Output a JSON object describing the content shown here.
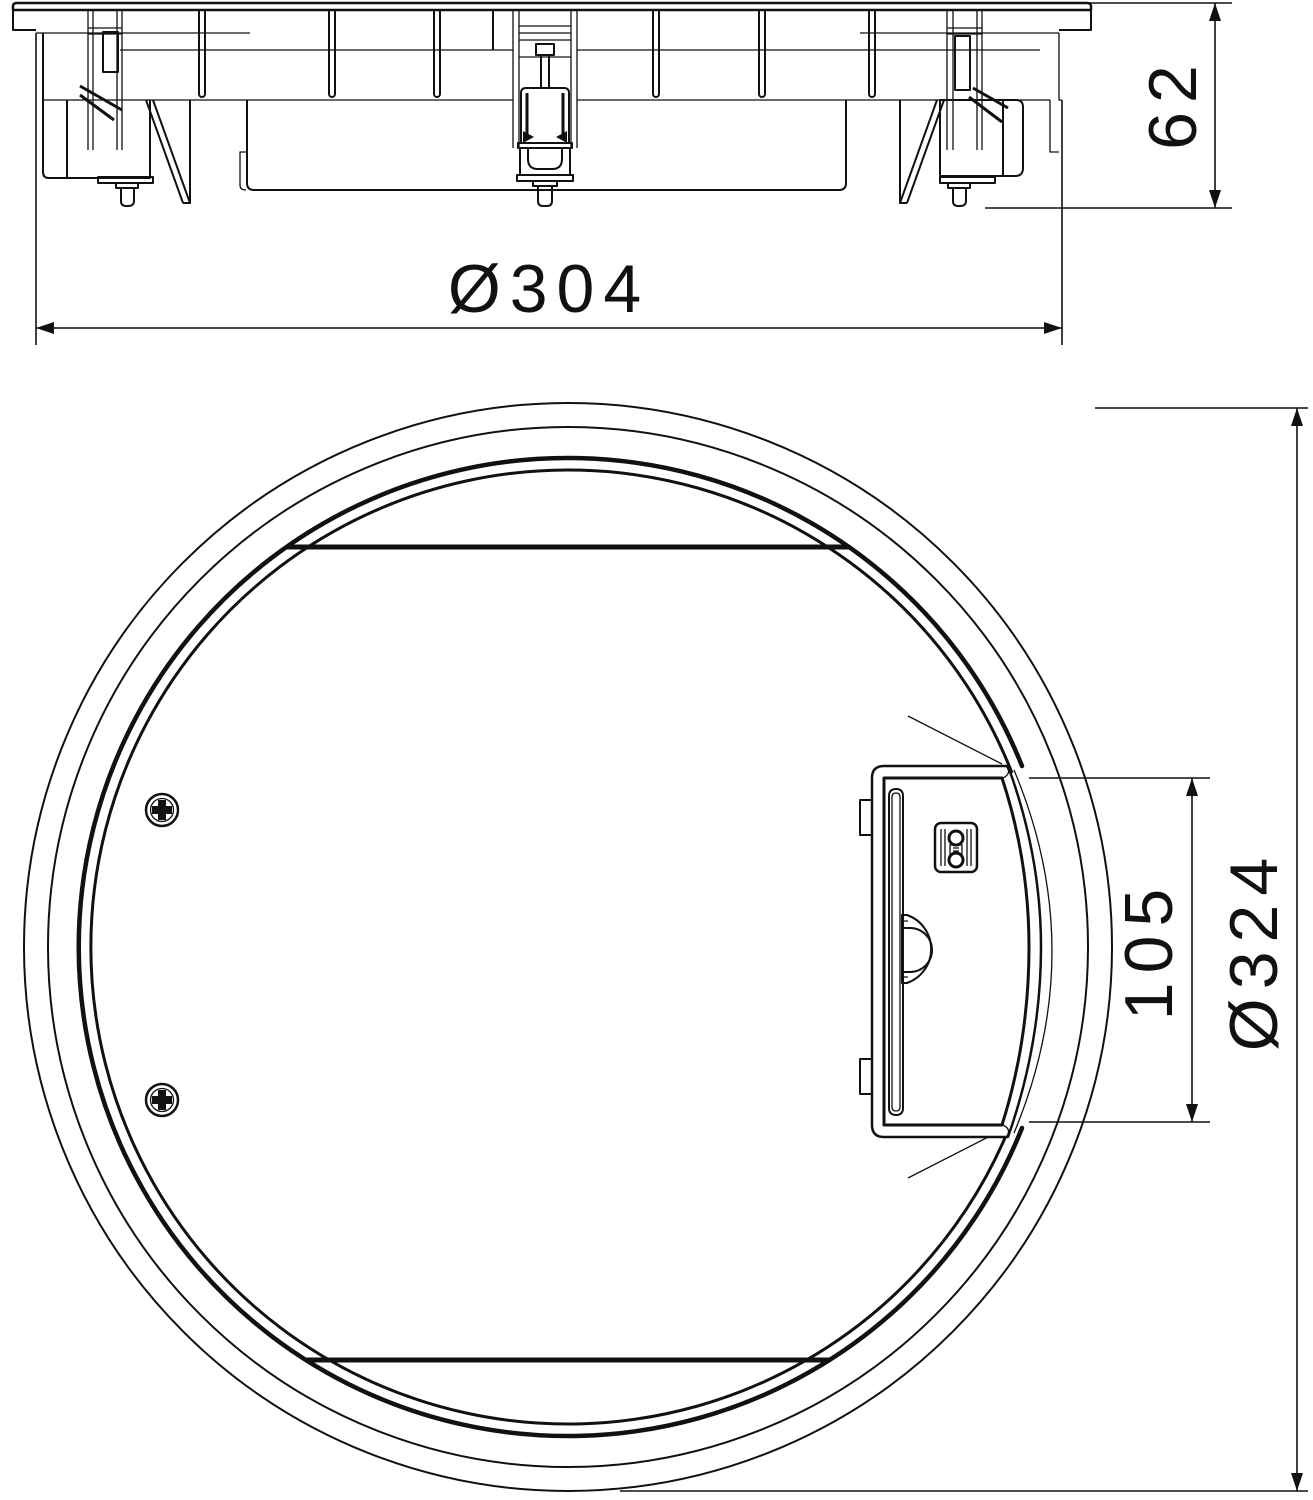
{
  "drawing": {
    "background": "#ffffff",
    "line_color": "#111111",
    "views": {
      "side_section": {
        "dim_height": "62",
        "dim_flange_diameter": "Ø304"
      },
      "plan": {
        "dim_latch_height": "105",
        "dim_outer_diameter": "Ø324"
      }
    }
  }
}
